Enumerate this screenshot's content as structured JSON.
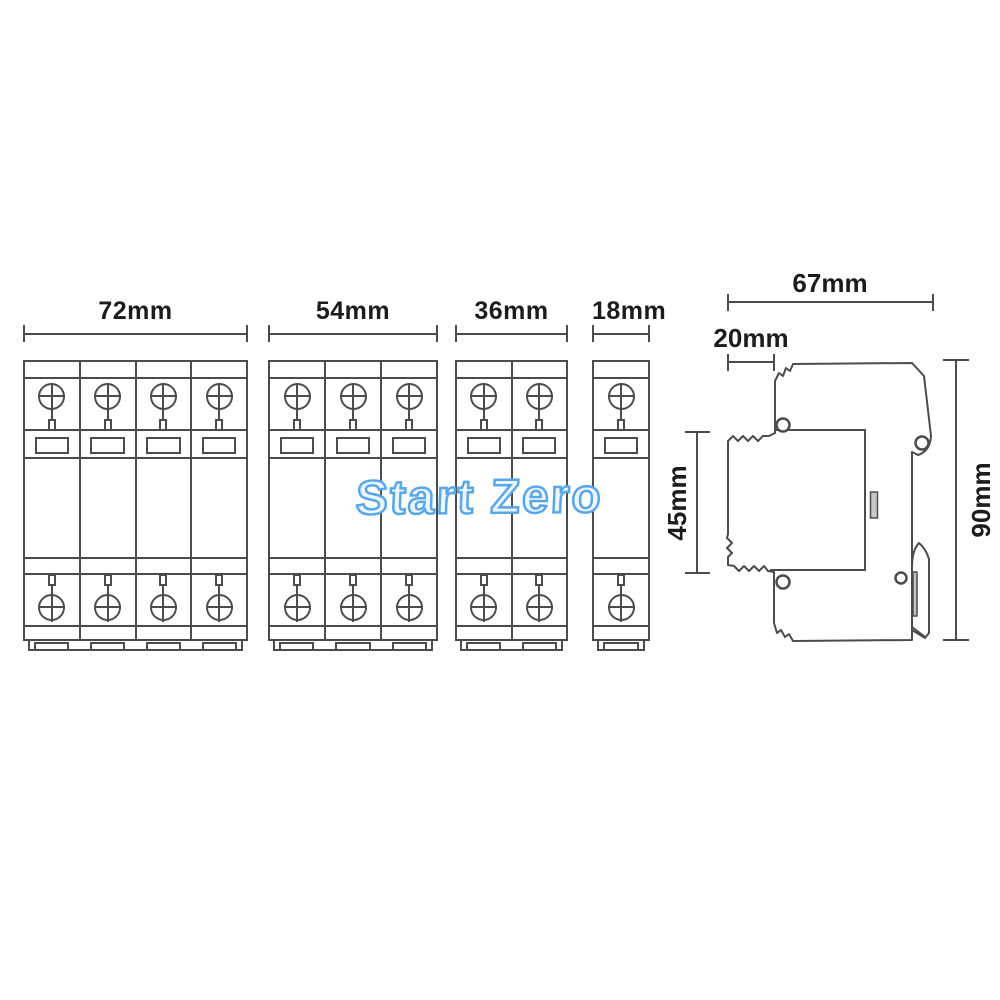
{
  "watermark": {
    "text": "Start Zero"
  },
  "front_view": {
    "blocks": [
      {
        "id": "4-pole",
        "label": "72mm",
        "poles": 4,
        "x": 23,
        "width": 225
      },
      {
        "id": "3-pole",
        "label": "54mm",
        "poles": 3,
        "x": 268,
        "width": 170
      },
      {
        "id": "2-pole",
        "label": "36mm",
        "poles": 2,
        "x": 455,
        "width": 113
      },
      {
        "id": "1-pole",
        "label": "18mm",
        "poles": 1,
        "x": 592,
        "width": 58
      }
    ]
  },
  "side_view": {
    "width_total": "67mm",
    "width_front": "20mm",
    "height_body": "45mm",
    "height_total": "90mm"
  },
  "colors": {
    "line": "#4c4c4c",
    "text": "#1c1c1c",
    "watermark_stroke": "#58a7ea",
    "watermark_fill": "#edf5fd",
    "slot_fill": "#c6c6c6"
  }
}
